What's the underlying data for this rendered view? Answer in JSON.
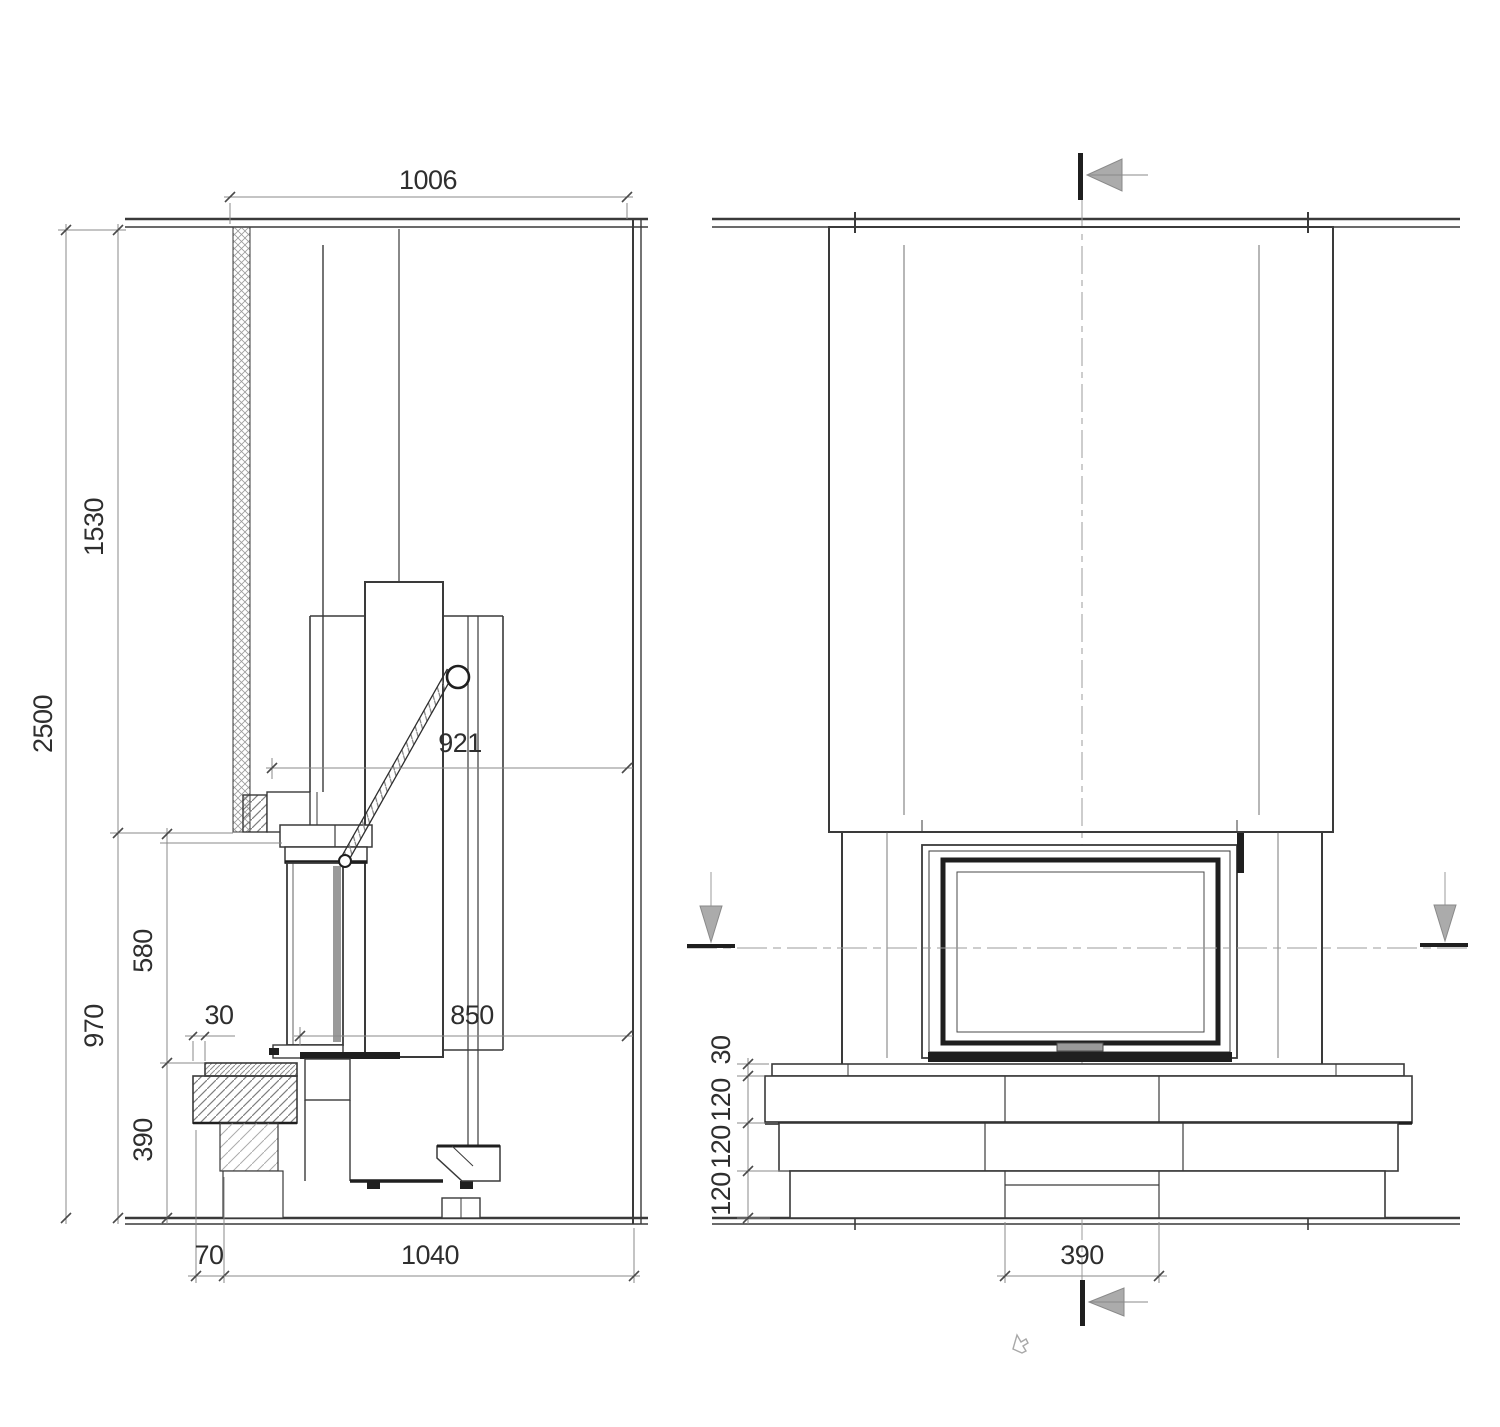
{
  "drawing": {
    "type": "technical-installation-drawing",
    "subject": "fireplace insert with chase, side section and front elevation",
    "colors": {
      "line": "#3a3a3a",
      "dark": "#1f1f1f",
      "dimension": "#8a8a8a",
      "arrow_fill": "#ababab",
      "hatch": "#8f8f8f",
      "background": "#ffffff"
    },
    "side_view": {
      "name": "side section view",
      "dims": {
        "top_width": "1006",
        "total_height": "2500",
        "upper_height": "1530",
        "lower_height": "970",
        "door_height": "580",
        "bench_height": "390",
        "bench_offset": "30",
        "handle_depth": "921",
        "firebox_depth": "850",
        "front_gap": "70",
        "base_depth": "1040"
      }
    },
    "front_view": {
      "name": "front elevation view",
      "dims": {
        "slab_thickness": "30",
        "course_1": "120",
        "course_2": "120",
        "course_3": "120",
        "center_block_width": "390"
      }
    }
  }
}
